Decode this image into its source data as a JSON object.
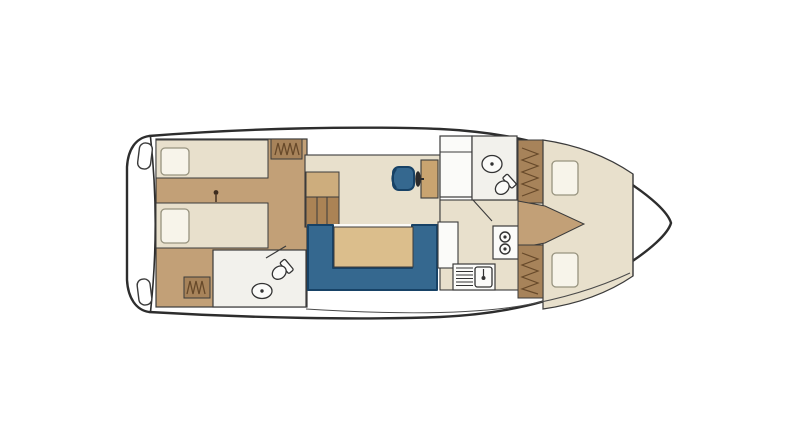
{
  "canvas": {
    "width_px": 800,
    "height_px": 446
  },
  "diagram": {
    "type": "boat-floor-plan",
    "sections": {
      "stern": [
        "swim-platform",
        "fender",
        "fender"
      ],
      "aft_cabin": [
        "double-berth-top",
        "double-berth-bottom",
        "pillow",
        "pillow",
        "wardrobe",
        "wardrobe",
        "ceiling-lamp"
      ],
      "aft_bathroom": [
        "toilet",
        "washbasin",
        "door"
      ],
      "salon": [
        "companionway-stairs",
        "u-shaped-sofa",
        "dining-table",
        "helm-seat",
        "steering-wheel",
        "helm-console",
        "cabinet"
      ],
      "galley": [
        "two-burner-stove",
        "sink-with-drainer",
        "counter"
      ],
      "bow_bathroom": [
        "toilet",
        "washbasin",
        "door"
      ],
      "bow_cabin": [
        "v-berth",
        "pillow",
        "pillow",
        "wardrobe",
        "wardrobe",
        "entry-step"
      ]
    }
  },
  "colors": {
    "canvas_bg": "#ffffff",
    "hull_fill": "#ffffff",
    "hull_stroke": "#2d2d2d",
    "wall_stroke": "#3b3b3b",
    "floor_beige": "#e8e0cc",
    "floor_tan": "#c2a077",
    "wood_step_light": "#cdad7d",
    "wood_step_dark": "#ab8355",
    "wardrobe_brown": "#a7835a",
    "wardrobe_hatch": "#67492a",
    "console_tan": "#c9a470",
    "table_tan": "#dbbe8c",
    "sofa_blue": "#35688f",
    "sofa_blue_dark": "#174266",
    "bathroom_floor": "#f2f1ec",
    "fixture_fill": "#fbfbf9",
    "fixture_stroke": "#333333",
    "pillow_fill": "#f7f4ea",
    "pillow_stroke": "#97937f",
    "lamp_dot": "#3d2c1e",
    "deck_line": "#4a4a4a"
  }
}
